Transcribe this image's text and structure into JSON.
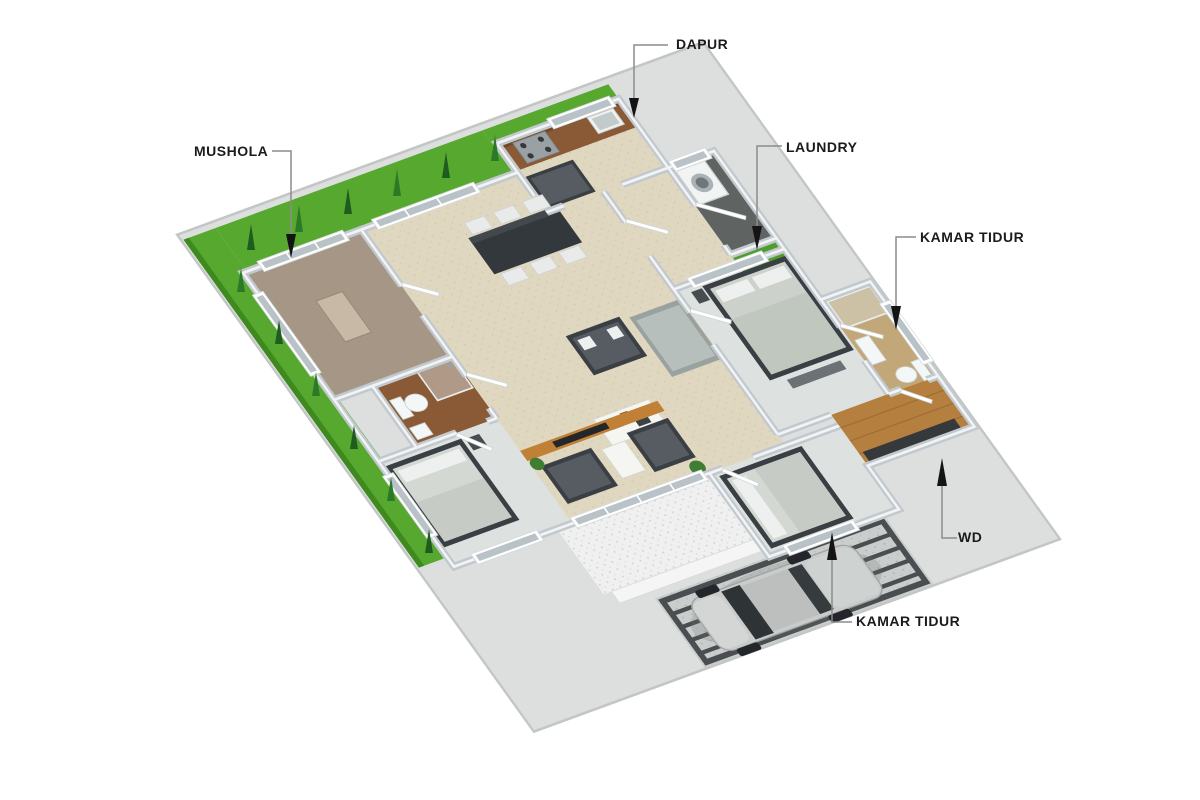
{
  "figure": {
    "type": "3d-isometric-house-floor-plan",
    "background_color": "#ffffff"
  },
  "annotations": [
    {
      "id": "dapur",
      "label": "DAPUR"
    },
    {
      "id": "mushola",
      "label": "MUSHOLA"
    },
    {
      "id": "laundry",
      "label": "LAUNDRY"
    },
    {
      "id": "kamar-tidur-1",
      "label": "KAMAR TIDUR"
    },
    {
      "id": "wd",
      "label": "WD"
    },
    {
      "id": "kamar-tidur-2",
      "label": "KAMAR TIDUR"
    }
  ],
  "palette": {
    "label_text": "#1b1b1b",
    "leader_line": "#8c8c8c",
    "arrow": "#141414",
    "wall": "#c2c9ce",
    "wall_top": "#f1f3f4",
    "floor_main_beige": "#e0d7c1",
    "floor_mushola": "#a59686",
    "floor_bath_tile": "#8a5a36",
    "floor_wood": "#b5803f",
    "floor_bedroom": "#dde2e1",
    "laundry_floor": "#5f6463",
    "grass": "#57a82e",
    "courtyard_grass": "#4f9e2d",
    "terrace": "#eff0ef",
    "carport": "#c9cdcc",
    "carport_stripe": "#4a4e51",
    "furniture_dark": "#3a3f44",
    "sofa_gray": "#b7bfbc",
    "kitchen_counter": "#8a5a36",
    "car_body": "#c9cccb",
    "plot_slab": "#dcdfdd"
  }
}
